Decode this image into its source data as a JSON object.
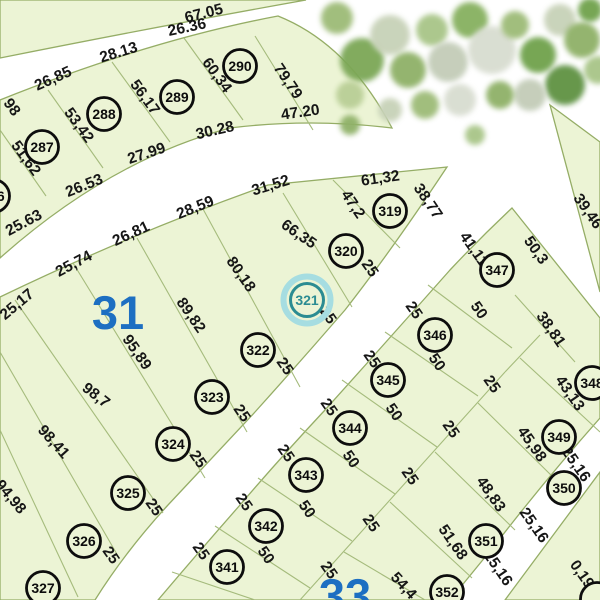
{
  "map": {
    "selected_parcel": "321",
    "colors": {
      "background": "#ffffff",
      "parcel_fill": "#ecf4d5",
      "region_stroke": "#95ad66",
      "boundary_line": "#a5bb7c",
      "circle_stroke": "#0d0d0d",
      "label_text": "#161616",
      "block_number": "#1d6fc2",
      "highlight_inner": "#2b8c92",
      "highlight_outer": "#a6dde1"
    },
    "block_numbers": [
      {
        "text": "31",
        "x": 118,
        "y": 313
      },
      {
        "text": "33",
        "x": 345,
        "y": 596
      }
    ],
    "regions": [
      {
        "name": "top-strip",
        "d": "M0,0 L306,0 Q160,26 0,58 Z"
      },
      {
        "name": "block-287-290",
        "d": "M0,100 Q150,40 278,16 Q348,44 392,128 Q310,118 230,128 Q110,160 0,258 Z"
      },
      {
        "name": "block-31",
        "d": "M0,297 Q135,232 268,185 L447,167 Q392,250 345,310 Q300,362 255,412 Q212,458 168,505 Q125,552 95,600 L0,600 Z"
      },
      {
        "name": "block-33",
        "d": "M512,208 L600,318 L600,418 Q545,480 495,545 L450,600 L158,600 Q197,554 240,505 Q282,456 325,410 Q388,340 450,270 Q480,238 512,208 Z"
      },
      {
        "name": "triangle-ne",
        "d": "M550,105 L600,142 L600,292 Z"
      },
      {
        "name": "corner-se",
        "d": "M600,472 L600,600 L505,600 Z"
      }
    ],
    "boundary_lines": [
      [
        0,
        130,
        46,
        196
      ],
      [
        48,
        90,
        103,
        168
      ],
      [
        112,
        62,
        170,
        142
      ],
      [
        184,
        38,
        243,
        120
      ],
      [
        255,
        36,
        313,
        130
      ],
      [
        333,
        180,
        400,
        248
      ],
      [
        283,
        193,
        352,
        307
      ],
      [
        203,
        209,
        300,
        387
      ],
      [
        137,
        238,
        247,
        432
      ],
      [
        73,
        263,
        205,
        478
      ],
      [
        15,
        300,
        163,
        513
      ],
      [
        0,
        352,
        118,
        556
      ],
      [
        0,
        430,
        78,
        597
      ],
      [
        428,
        285,
        512,
        348
      ],
      [
        385,
        332,
        478,
        396
      ],
      [
        342,
        380,
        437,
        447
      ],
      [
        300,
        428,
        395,
        494
      ],
      [
        258,
        478,
        352,
        541
      ],
      [
        215,
        526,
        310,
        588
      ],
      [
        172,
        572,
        255,
        600
      ],
      [
        540,
        335,
        505,
        372
      ],
      [
        505,
        372,
        318,
        580
      ],
      [
        318,
        580,
        300,
        600
      ],
      [
        515,
        295,
        575,
        362
      ],
      [
        520,
        358,
        600,
        432
      ],
      [
        478,
        403,
        558,
        482
      ],
      [
        435,
        452,
        515,
        530
      ],
      [
        390,
        502,
        472,
        578
      ],
      [
        344,
        552,
        425,
        600
      ]
    ],
    "dimensions": [
      {
        "t": "67.05",
        "x": 205,
        "y": 18,
        "r": -14
      },
      {
        "t": "26,85",
        "x": 55,
        "y": 83,
        "r": -24
      },
      {
        "t": "28.13",
        "x": 120,
        "y": 57,
        "r": -17
      },
      {
        "t": "26.36",
        "x": 188,
        "y": 32,
        "r": -12
      },
      {
        "t": "98",
        "x": 8,
        "y": 110,
        "r": 54
      },
      {
        "t": "51,62",
        "x": 22,
        "y": 161,
        "r": 54
      },
      {
        "t": "53,42",
        "x": 75,
        "y": 128,
        "r": 54
      },
      {
        "t": "56,17",
        "x": 141,
        "y": 100,
        "r": 54
      },
      {
        "t": "60,34",
        "x": 213,
        "y": 78,
        "r": 54
      },
      {
        "t": "79,79",
        "x": 284,
        "y": 84,
        "r": 56
      },
      {
        "t": "47.20",
        "x": 301,
        "y": 117,
        "r": -8
      },
      {
        "t": "25.63",
        "x": 26,
        "y": 227,
        "r": -28
      },
      {
        "t": "26.53",
        "x": 86,
        "y": 190,
        "r": -22
      },
      {
        "t": "27.99",
        "x": 148,
        "y": 158,
        "r": -18
      },
      {
        "t": "30.28",
        "x": 216,
        "y": 135,
        "r": -13
      },
      {
        "t": "31,52",
        "x": 272,
        "y": 190,
        "r": -17
      },
      {
        "t": "61,32",
        "x": 381,
        "y": 183,
        "r": -8
      },
      {
        "t": "47,2",
        "x": 349,
        "y": 207,
        "r": 56
      },
      {
        "t": "38,77",
        "x": 424,
        "y": 204,
        "r": 56
      },
      {
        "t": "39,46",
        "x": 584,
        "y": 214,
        "r": 55
      },
      {
        "t": "66,35",
        "x": 296,
        "y": 238,
        "r": 35
      },
      {
        "t": "28,59",
        "x": 197,
        "y": 212,
        "r": -22
      },
      {
        "t": "26,81",
        "x": 133,
        "y": 238,
        "r": -25
      },
      {
        "t": "25,74",
        "x": 76,
        "y": 268,
        "r": -28
      },
      {
        "t": "25,17",
        "x": 20,
        "y": 308,
        "r": -40
      },
      {
        "t": "80,18",
        "x": 237,
        "y": 277,
        "r": 55
      },
      {
        "t": "89,82",
        "x": 187,
        "y": 318,
        "r": 55
      },
      {
        "t": "95,89",
        "x": 133,
        "y": 355,
        "r": 55
      },
      {
        "t": "98,7",
        "x": 93,
        "y": 399,
        "r": 38
      },
      {
        "t": "98,41",
        "x": 50,
        "y": 445,
        "r": 48
      },
      {
        "t": "94,98",
        "x": 7,
        "y": 500,
        "r": 50
      },
      {
        "t": "41,11",
        "x": 470,
        "y": 252,
        "r": 55
      },
      {
        "t": "50,3",
        "x": 532,
        "y": 253,
        "r": 55
      },
      {
        "t": "25",
        "x": 366,
        "y": 271,
        "r": 55
      },
      {
        "t": "25",
        "x": 324,
        "y": 318,
        "r": 55
      },
      {
        "t": "25",
        "x": 281,
        "y": 369,
        "r": 55
      },
      {
        "t": "25",
        "x": 238,
        "y": 416,
        "r": 55
      },
      {
        "t": "25",
        "x": 194,
        "y": 462,
        "r": 55
      },
      {
        "t": "25",
        "x": 150,
        "y": 510,
        "r": 55
      },
      {
        "t": "25",
        "x": 107,
        "y": 558,
        "r": 55
      },
      {
        "t": "25",
        "x": 410,
        "y": 313,
        "r": 55
      },
      {
        "t": "25",
        "x": 368,
        "y": 362,
        "r": 55
      },
      {
        "t": "25",
        "x": 325,
        "y": 410,
        "r": 55
      },
      {
        "t": "25",
        "x": 282,
        "y": 456,
        "r": 55
      },
      {
        "t": "25",
        "x": 240,
        "y": 505,
        "r": 55
      },
      {
        "t": "25",
        "x": 197,
        "y": 554,
        "r": 55
      },
      {
        "t": "50",
        "x": 475,
        "y": 313,
        "r": 55
      },
      {
        "t": "50",
        "x": 433,
        "y": 365,
        "r": 55
      },
      {
        "t": "50",
        "x": 390,
        "y": 415,
        "r": 55
      },
      {
        "t": "50",
        "x": 347,
        "y": 462,
        "r": 55
      },
      {
        "t": "50",
        "x": 303,
        "y": 512,
        "r": 55
      },
      {
        "t": "50",
        "x": 262,
        "y": 558,
        "r": 55
      },
      {
        "t": "25",
        "x": 488,
        "y": 387,
        "r": 55
      },
      {
        "t": "25",
        "x": 447,
        "y": 432,
        "r": 55
      },
      {
        "t": "25",
        "x": 406,
        "y": 479,
        "r": 55
      },
      {
        "t": "25",
        "x": 367,
        "y": 526,
        "r": 55
      },
      {
        "t": "25",
        "x": 325,
        "y": 573,
        "r": 55
      },
      {
        "t": "38,81",
        "x": 547,
        "y": 332,
        "r": 55
      },
      {
        "t": "43,13",
        "x": 566,
        "y": 396,
        "r": 55
      },
      {
        "t": "45,98",
        "x": 528,
        "y": 447,
        "r": 55
      },
      {
        "t": "48,83",
        "x": 487,
        "y": 497,
        "r": 55
      },
      {
        "t": "51,68",
        "x": 449,
        "y": 545,
        "r": 55
      },
      {
        "t": "54,4",
        "x": 400,
        "y": 589,
        "r": 48
      },
      {
        "t": "25,16",
        "x": 572,
        "y": 467,
        "r": 55
      },
      {
        "t": "25,16",
        "x": 530,
        "y": 528,
        "r": 55
      },
      {
        "t": "25,16",
        "x": 494,
        "y": 571,
        "r": 55
      },
      {
        "t": "0,19",
        "x": 578,
        "y": 577,
        "r": 55
      }
    ],
    "parcels": [
      {
        "id": "286",
        "x": -7,
        "y": 196
      },
      {
        "id": "287",
        "x": 42,
        "y": 147
      },
      {
        "id": "288",
        "x": 104,
        "y": 114
      },
      {
        "id": "289",
        "x": 177,
        "y": 97
      },
      {
        "id": "290",
        "x": 240,
        "y": 66
      },
      {
        "id": "319",
        "x": 390,
        "y": 211
      },
      {
        "id": "320",
        "x": 346,
        "y": 251
      },
      {
        "id": "321",
        "x": 307,
        "y": 300,
        "hl": true
      },
      {
        "id": "322",
        "x": 258,
        "y": 350
      },
      {
        "id": "323",
        "x": 212,
        "y": 397
      },
      {
        "id": "324",
        "x": 173,
        "y": 444
      },
      {
        "id": "325",
        "x": 128,
        "y": 493
      },
      {
        "id": "326",
        "x": 84,
        "y": 541
      },
      {
        "id": "327",
        "x": 43,
        "y": 588
      },
      {
        "id": "341",
        "x": 227,
        "y": 567
      },
      {
        "id": "342",
        "x": 266,
        "y": 526
      },
      {
        "id": "343",
        "x": 306,
        "y": 475
      },
      {
        "id": "344",
        "x": 350,
        "y": 428
      },
      {
        "id": "345",
        "x": 388,
        "y": 380
      },
      {
        "id": "346",
        "x": 435,
        "y": 335
      },
      {
        "id": "347",
        "x": 497,
        "y": 270
      },
      {
        "id": "348",
        "x": 592,
        "y": 383
      },
      {
        "id": "349",
        "x": 559,
        "y": 437
      },
      {
        "id": "350",
        "x": 564,
        "y": 488
      },
      {
        "id": "351",
        "x": 486,
        "y": 541
      },
      {
        "id": "352",
        "x": 447,
        "y": 592
      },
      {
        "id": "",
        "x": 597,
        "y": 599
      }
    ],
    "trees": [
      {
        "x": 337,
        "y": 18,
        "rad": 16,
        "c": "#9dbb77"
      },
      {
        "x": 362,
        "y": 60,
        "rad": 22,
        "c": "#7ca757"
      },
      {
        "x": 350,
        "y": 95,
        "rad": 14,
        "c": "#b9cf96"
      },
      {
        "x": 390,
        "y": 35,
        "rad": 20,
        "c": "#c7d2b8"
      },
      {
        "x": 408,
        "y": 70,
        "rad": 18,
        "c": "#8fb168"
      },
      {
        "x": 432,
        "y": 30,
        "rad": 16,
        "c": "#a8c587"
      },
      {
        "x": 448,
        "y": 62,
        "rad": 20,
        "c": "#c3ccb8"
      },
      {
        "x": 470,
        "y": 20,
        "rad": 18,
        "c": "#86b05e"
      },
      {
        "x": 492,
        "y": 50,
        "rad": 24,
        "c": "#d8ddd0"
      },
      {
        "x": 515,
        "y": 25,
        "rad": 14,
        "c": "#9dbb77"
      },
      {
        "x": 538,
        "y": 55,
        "rad": 18,
        "c": "#6fa24c"
      },
      {
        "x": 560,
        "y": 20,
        "rad": 16,
        "c": "#c7d2b8"
      },
      {
        "x": 582,
        "y": 40,
        "rad": 18,
        "c": "#8fb168"
      },
      {
        "x": 598,
        "y": 70,
        "rad": 14,
        "c": "#a8c587"
      },
      {
        "x": 565,
        "y": 85,
        "rad": 20,
        "c": "#5e9243"
      },
      {
        "x": 530,
        "y": 95,
        "rad": 16,
        "c": "#c3ccb8"
      },
      {
        "x": 500,
        "y": 95,
        "rad": 14,
        "c": "#8fb168"
      },
      {
        "x": 460,
        "y": 100,
        "rad": 16,
        "c": "#d8ddd0"
      },
      {
        "x": 425,
        "y": 105,
        "rad": 14,
        "c": "#9dbb77"
      },
      {
        "x": 390,
        "y": 110,
        "rad": 12,
        "c": "#c7d2b8"
      },
      {
        "x": 350,
        "y": 125,
        "rad": 10,
        "c": "#8fb168"
      },
      {
        "x": 475,
        "y": 135,
        "rad": 10,
        "c": "#a8c587"
      },
      {
        "x": 590,
        "y": 10,
        "rad": 12,
        "c": "#6fa24c"
      }
    ]
  }
}
